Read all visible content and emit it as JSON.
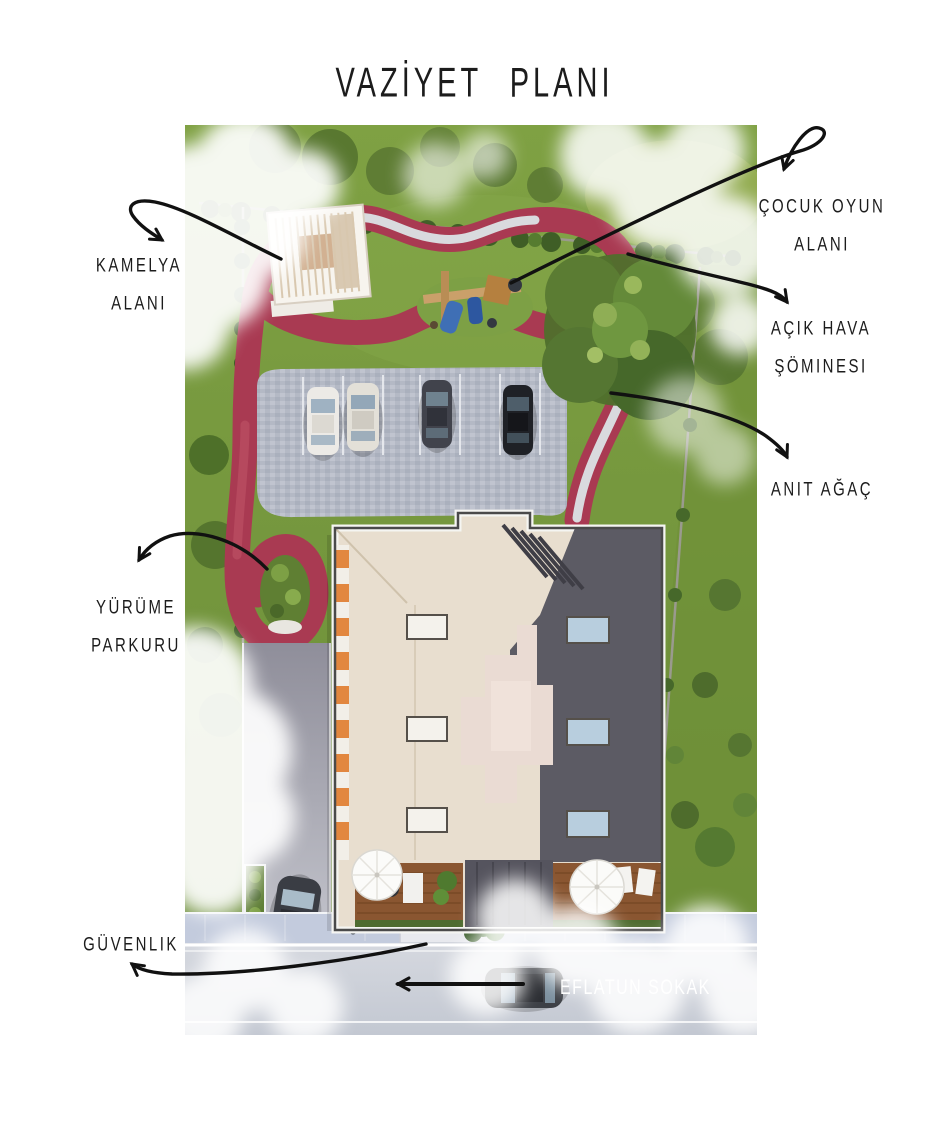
{
  "page": {
    "title": "VAZİYET PLANI"
  },
  "annotations": {
    "kamelya": {
      "line1": "KAMELYA",
      "line2": "ALANI"
    },
    "cocuk_oyun": {
      "line1": "ÇOCUK OYUN",
      "line2": "ALANI"
    },
    "acik_hava": {
      "line1": "AÇIK HAVA",
      "line2": "ŞÖMINESI"
    },
    "anit_agac": {
      "line1": "ANIT AĞAÇ"
    },
    "yurume": {
      "line1": "YÜRÜME",
      "line2": "PARKURU"
    },
    "guvenlik": {
      "line1": "GÜVENLIK"
    }
  },
  "plan": {
    "street_name": "EFLATUN SOKAK",
    "colors": {
      "walking_path_red": "#a93a52",
      "lawn_green": "#74963d",
      "roof_light": "#e8decf",
      "roof_dark": "#5c5b64",
      "street_gray": "#ccd1d9",
      "annotation_black": "#1a1a1a",
      "street_text": "#ffffff"
    }
  }
}
